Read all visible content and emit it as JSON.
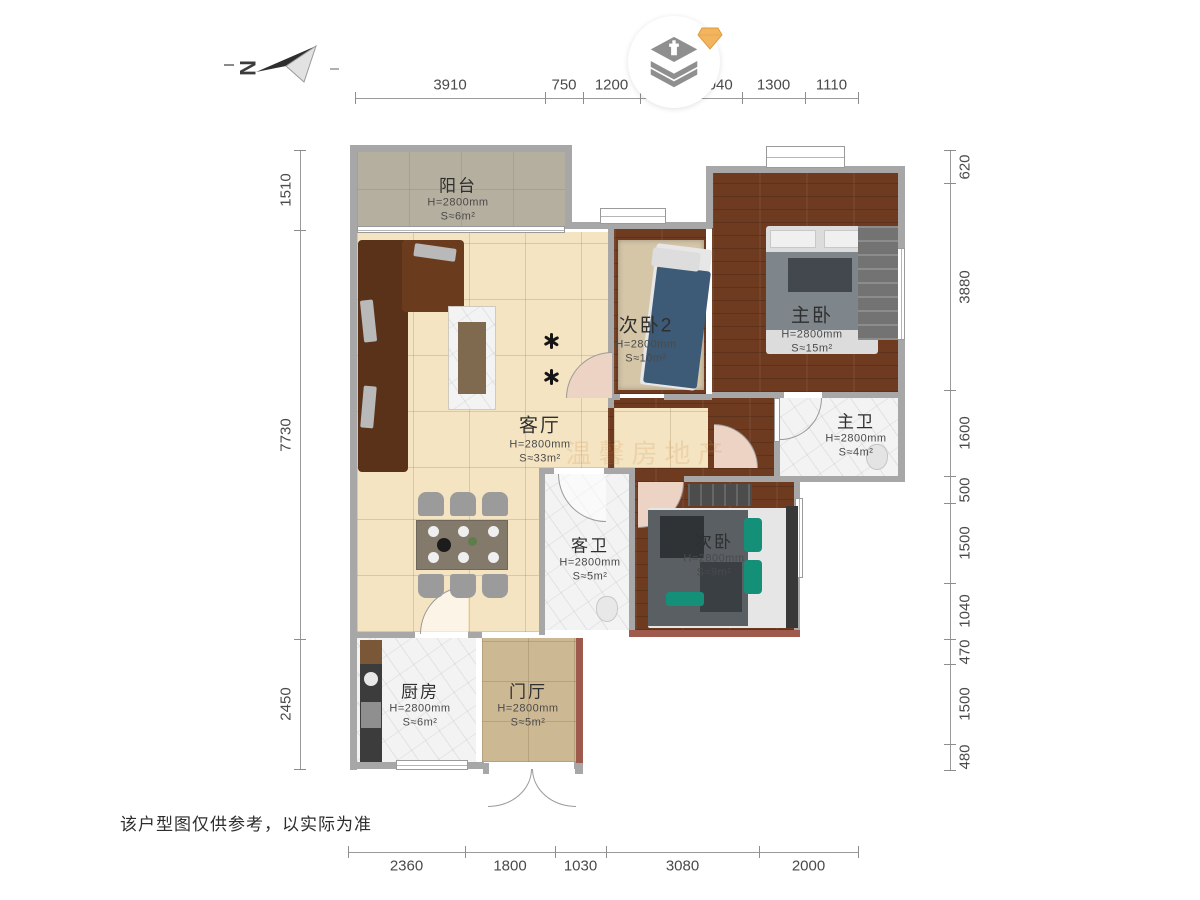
{
  "page": {
    "disclaimer": "该户型图仅供参考，以实际为准"
  },
  "compass": {
    "label": "N"
  },
  "watermark": {
    "text": "温馨房地产"
  },
  "rooms": [
    {
      "id": "balcony",
      "name": "阳台",
      "height": "H=2800mm",
      "area": "S≈6m²"
    },
    {
      "id": "bedroom2",
      "name": "次卧2",
      "height": "H=2800mm",
      "area": "S≈10m²"
    },
    {
      "id": "master",
      "name": "主卧",
      "height": "H=2800mm",
      "area": "S≈15m²"
    },
    {
      "id": "living",
      "name": "客厅",
      "height": "H=2800mm",
      "area": "S≈33m²"
    },
    {
      "id": "master-bath",
      "name": "主卫",
      "height": "H=2800mm",
      "area": "S≈4m²"
    },
    {
      "id": "guest-bath",
      "name": "客卫",
      "height": "H=2800mm",
      "area": "S≈5m²"
    },
    {
      "id": "bedroom",
      "name": "次卧",
      "height": "H=2800mm",
      "area": "S≈9m²"
    },
    {
      "id": "kitchen",
      "name": "厨房",
      "height": "H=2800mm",
      "area": "S≈6m²"
    },
    {
      "id": "entry",
      "name": "门厅",
      "height": "H=2800mm",
      "area": "S≈5m²"
    }
  ],
  "dimensions": {
    "top": [
      "3910",
      "750",
      "1200",
      "",
      "1040",
      "1300",
      "1110"
    ],
    "bottom": [
      "2360",
      "1800",
      "1030",
      "3080",
      "2000"
    ],
    "left": [
      "1510",
      "7730",
      "2450"
    ],
    "right": [
      "620",
      "3880",
      "1600",
      "500",
      "1500",
      "1040",
      "470",
      "1500",
      "480"
    ]
  },
  "colors": {
    "wall": "#a7a7a7",
    "accent_wall": "#9e5a4d",
    "gem": "#f2b45c",
    "wood_floor": "#6e3b20",
    "living_floor": "#f4e4c2"
  }
}
